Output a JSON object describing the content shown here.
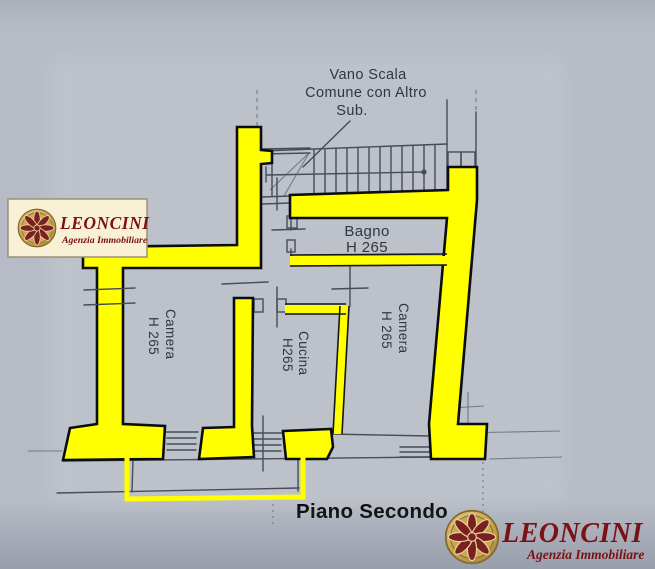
{
  "document": {
    "type": "floor-plan-scan",
    "floor_label": "Piano Secondo"
  },
  "plan": {
    "stairwell_label": {
      "line1": "Vano Scala",
      "line2": "Comune con Altro",
      "line3": "Sub."
    },
    "rooms": {
      "bagno": {
        "name": "Bagno",
        "height": "H 265"
      },
      "camera_left": {
        "name": "Camera",
        "height": "H 265"
      },
      "cucina": {
        "name": "Cucina",
        "height": "H265"
      },
      "camera_right": {
        "name": "Camera",
        "height": "H 265"
      }
    }
  },
  "branding": {
    "top_left": {
      "name": "LEONCINI",
      "tagline": "Agenzia Immobiliare"
    },
    "bottom_right": {
      "name": "LEONCINI",
      "tagline": "Agenzia Immobiliare"
    }
  },
  "colors": {
    "background": "#b6bbc5",
    "wall_highlight": "#ffff00",
    "plan_line": "#474c57",
    "logo_red": "#7b1113",
    "logo_panel": "#f8f1d6",
    "gold": "#c9a750"
  }
}
